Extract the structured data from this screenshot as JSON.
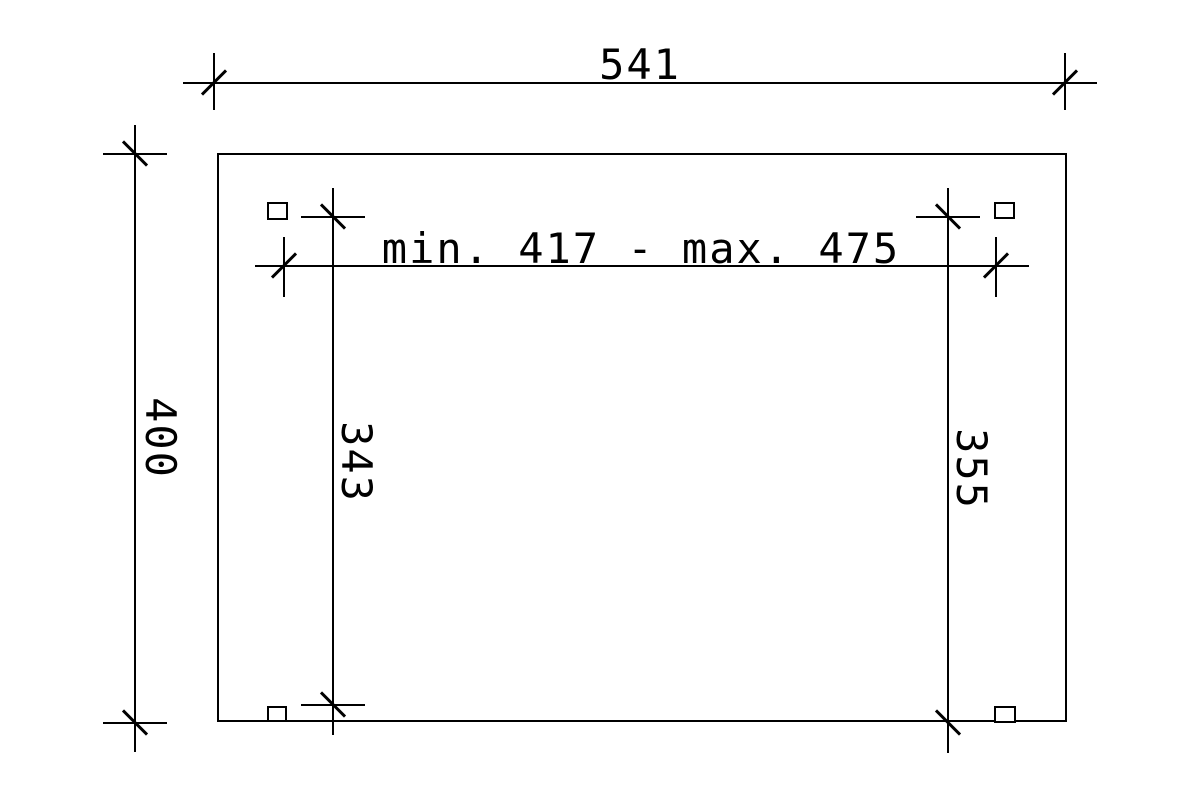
{
  "drawing": {
    "background_color": "#ffffff",
    "line_color": "#000000",
    "type": "carport-plan-dimension-drawing",
    "labels": {
      "overall_width": "541",
      "overall_depth": "400",
      "clear_width": "min. 417 - max. 475",
      "inner_depth_left": "343",
      "inner_depth_right": "355"
    }
  }
}
